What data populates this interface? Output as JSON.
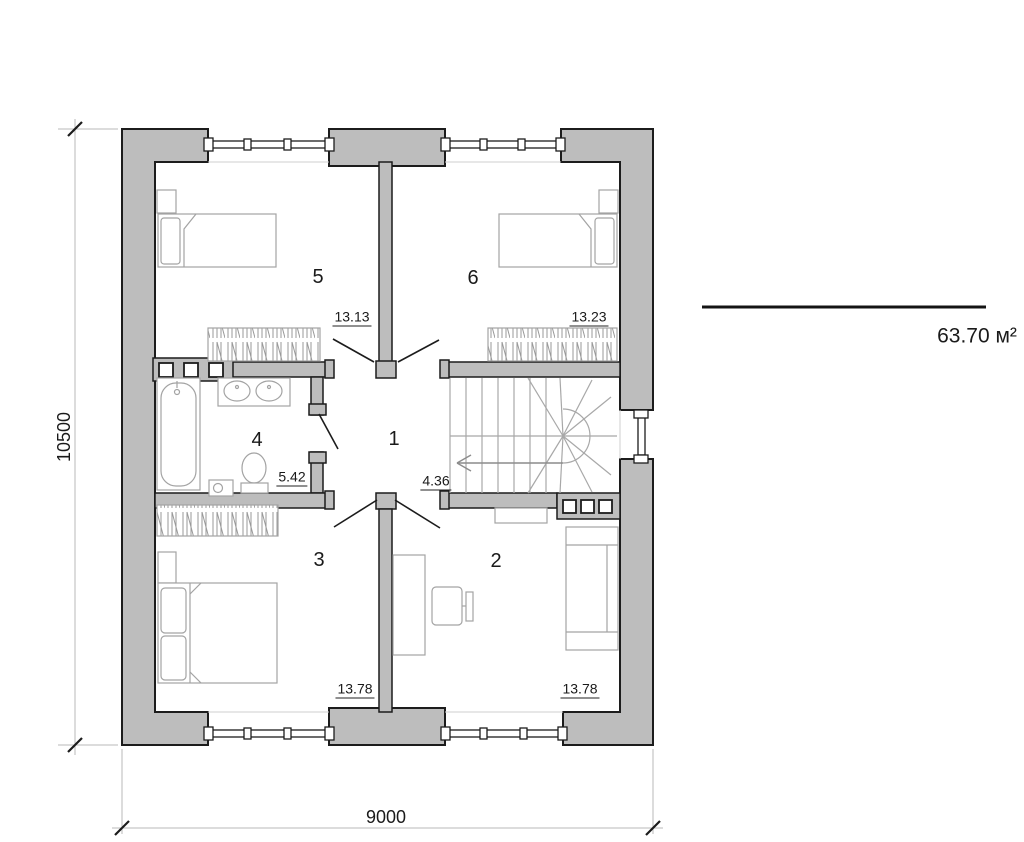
{
  "plan": {
    "total_area": "63.70 м²",
    "dimensions": {
      "width": "9000",
      "height": "10500"
    },
    "rooms": [
      {
        "number": "1",
        "area": "4.36"
      },
      {
        "number": "2",
        "area": "13.78"
      },
      {
        "number": "3",
        "area": "13.78"
      },
      {
        "number": "4",
        "area": "5.42"
      },
      {
        "number": "5",
        "area": "13.13"
      },
      {
        "number": "6",
        "area": "13.23"
      }
    ],
    "colors": {
      "wall_fill": "#bdbdbd",
      "outline": "#1c1c1c",
      "furniture_stroke": "#a3a3a3",
      "stair_stroke": "#a8a8a8",
      "dim_line": "#b8b8b8"
    }
  }
}
